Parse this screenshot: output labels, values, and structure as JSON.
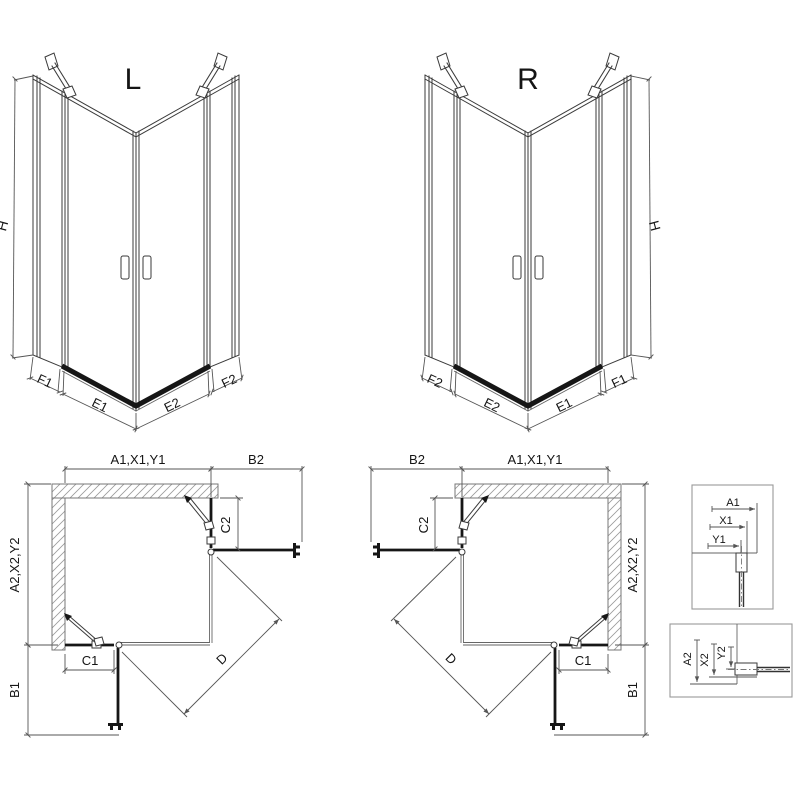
{
  "colors": {
    "background": "#ffffff",
    "line": "#3a3a3a",
    "glass": "#161616",
    "dim": "#555555",
    "hatch": "#9a9a9a"
  },
  "iso_views": {
    "left": {
      "title": "L",
      "height_label": "H",
      "segment_labels": [
        "F1",
        "E1",
        "E2",
        "F2"
      ]
    },
    "right": {
      "title": "R",
      "height_label": "H",
      "segment_labels": [
        "F2",
        "E2",
        "E1",
        "F1"
      ]
    }
  },
  "plan_views": {
    "left": {
      "width_top": "A1,X1,Y1",
      "door_top": "B2",
      "fixed_right": "C2",
      "depth_side": "A2,X2,Y2",
      "door_side": "B1",
      "fixed_bottom": "C1",
      "diagonal": "D"
    },
    "right": {
      "width_top": "A1,X1,Y1",
      "door_top": "B2",
      "fixed_right": "C2",
      "depth_side": "A2,X2,Y2",
      "door_side": "B1",
      "fixed_bottom": "C1",
      "diagonal": "D"
    }
  },
  "details": {
    "top": {
      "dims": [
        "A1",
        "X1",
        "Y1"
      ]
    },
    "bottom": {
      "dims": [
        "A2",
        "X2",
        "Y2"
      ]
    }
  }
}
